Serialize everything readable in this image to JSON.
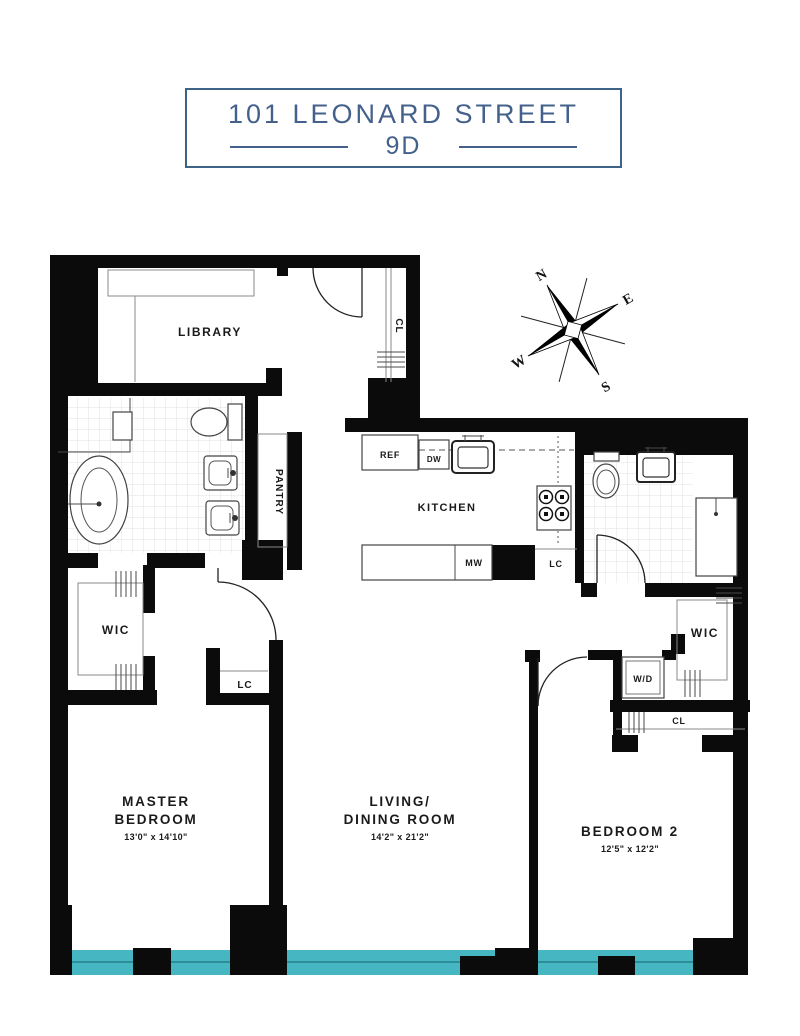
{
  "title_block": {
    "address": "101 LEONARD STREET",
    "unit": "9D"
  },
  "compass": {
    "north": "N",
    "east": "E",
    "south": "S",
    "west": "W"
  },
  "rooms": {
    "library": {
      "label": "LIBRARY"
    },
    "pantry": {
      "label": "PANTRY"
    },
    "kitchen": {
      "label": "KITCHEN"
    },
    "master_bedroom": {
      "name_line1": "MASTER",
      "name_line2": "BEDROOM",
      "dimensions": "13'0\" x 14'10\""
    },
    "living_dining": {
      "name_line1": "LIVING/",
      "name_line2": "DINING ROOM",
      "dimensions": "14'2\" x 21'2\""
    },
    "bedroom_2": {
      "name": "BEDROOM 2",
      "dimensions": "12'5\" x 12'2\""
    }
  },
  "closets": {
    "entry_closet": "CL",
    "master_wic": "WIC",
    "hall_linen_closet": "LC",
    "kitchen_linen_closet": "LC",
    "bedroom2_wic": "WIC",
    "bedroom2_closet": "CL",
    "washer_dryer": "W/D"
  },
  "appliances": {
    "refrigerator": "REF",
    "dishwasher": "DW",
    "microwave": "MW"
  },
  "colors": {
    "wall": "#0b0b0b",
    "window_glass": "#45b6c2",
    "title_blue": "#44618c"
  }
}
